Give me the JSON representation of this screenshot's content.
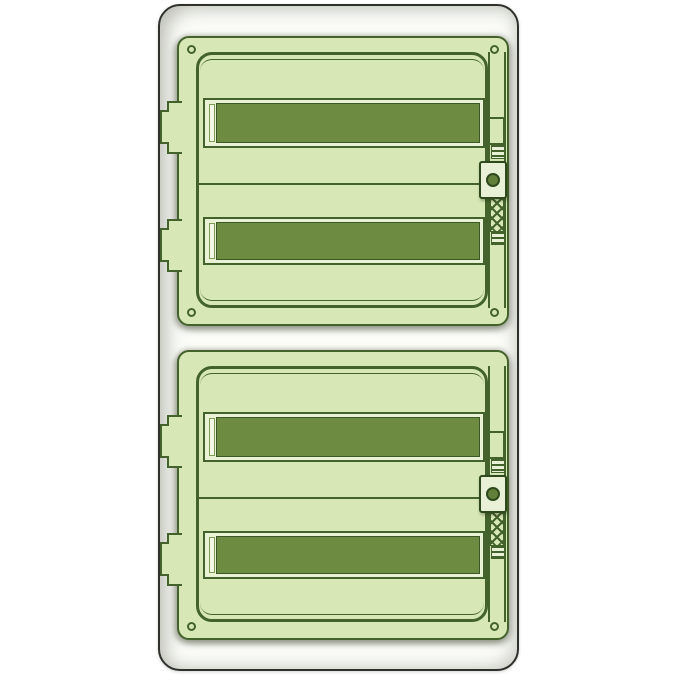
{
  "image": {
    "description": "Product illustration of a surface-mounted electrical distribution enclosure with two stacked transparent green doors, each covering two rows of DIN modules",
    "background_color": "#ffffff",
    "visible_text": "none"
  },
  "colors": {
    "enclosure_fill": "#fbfcf8",
    "enclosure_border": "#2d302b",
    "door_fill": "#d7e8b6",
    "door_border": "#44622c",
    "window_frame": "#e9f2d4",
    "window_fill": "#6d8c41",
    "window_shine": "#f3f8e6",
    "handle_fill": "#e8f1d6",
    "handle_border": "#2e4a1d",
    "knob_fill": "#62803a"
  },
  "enclosure": {
    "door_sections": [
      {
        "id": "top",
        "module_rows": 2,
        "corner_screws": [
          "top-left",
          "top-right",
          "bottom-left",
          "bottom-right"
        ],
        "hinge_tabs_left": 2,
        "latch": {
          "handle": true,
          "round_knob": true,
          "ribbed_vents": 2,
          "lattice_strip": true
        }
      },
      {
        "id": "bottom",
        "module_rows": 2,
        "corner_screws": [
          "bottom-left",
          "bottom-right"
        ],
        "hinge_tabs_left": 2,
        "latch": {
          "handle": true,
          "round_knob": true,
          "ribbed_vents": 2,
          "lattice_strip": true
        }
      }
    ]
  }
}
